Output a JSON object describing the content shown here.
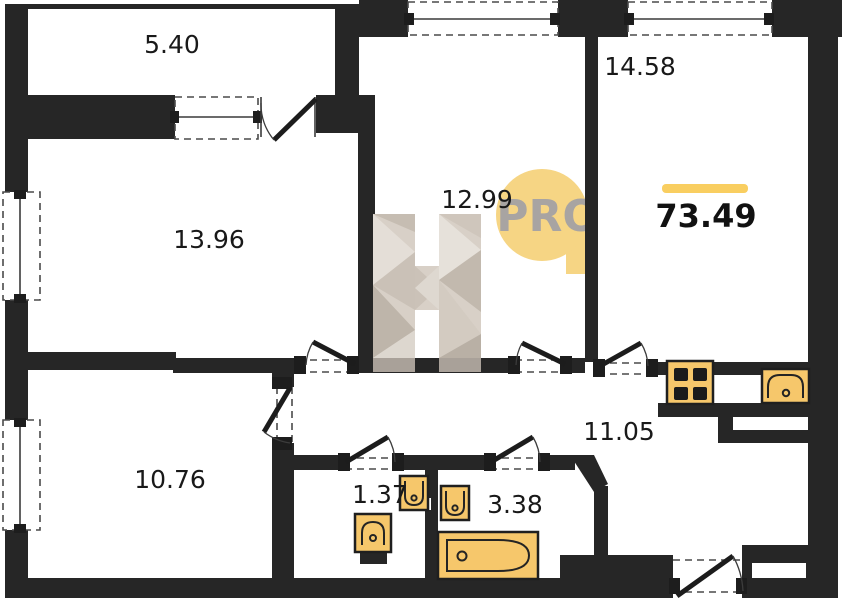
{
  "plan": {
    "total_area": "73.49",
    "rooms": [
      {
        "id": "balcony",
        "area": "5.40"
      },
      {
        "id": "room-14-58",
        "area": "14.58"
      },
      {
        "id": "room-12-99",
        "area": "12.99"
      },
      {
        "id": "room-13-96",
        "area": "13.96"
      },
      {
        "id": "room-10-76",
        "area": "10.76"
      },
      {
        "id": "hallway",
        "area": "11.05"
      },
      {
        "id": "wc",
        "area": "1.37"
      },
      {
        "id": "bathroom",
        "area": "3.38"
      }
    ],
    "watermark": {
      "letter": "H",
      "pro_label": "PRO"
    },
    "colors": {
      "wall": "#262626",
      "fixture": "#f6c76b",
      "total_bar": "#f9ce60",
      "pro_circle": "#f6d584",
      "pro_text": "#a8a4a2",
      "watermark_beige": "#d8d0c7"
    }
  }
}
